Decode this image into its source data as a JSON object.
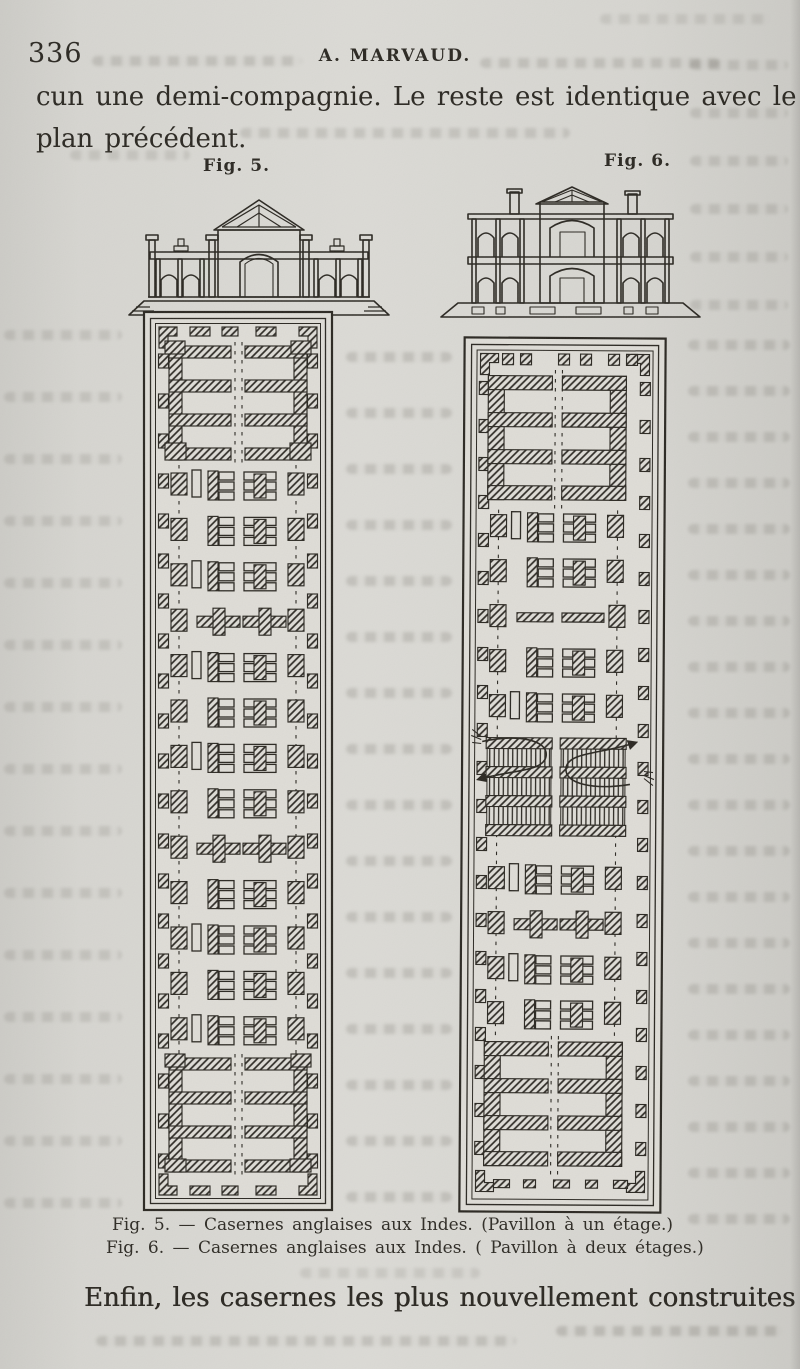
{
  "page": {
    "number": "336",
    "running_header": "A. MARVAUD.",
    "intro_line_1": "cun une demi-compagnie. Le reste est identique avec le",
    "intro_line_2": "plan précédent.",
    "closing_line": "Enfin, les casernes les plus nouvellement construites pré-"
  },
  "figures": {
    "fig5": {
      "label": "Fig. 5.",
      "caption": "Fig. 5. — Casernes anglaises aux Indes. (Pavillon à un étage.)"
    },
    "fig6": {
      "label": "Fig. 6.",
      "caption": "Fig. 6. — Casernes anglaises aux Indes. ( Pavillon à deux étages.)"
    }
  },
  "colors": {
    "paper": "#d6d5d1",
    "ink": "#2b2822",
    "ghost_text": "#b9b7b1"
  }
}
